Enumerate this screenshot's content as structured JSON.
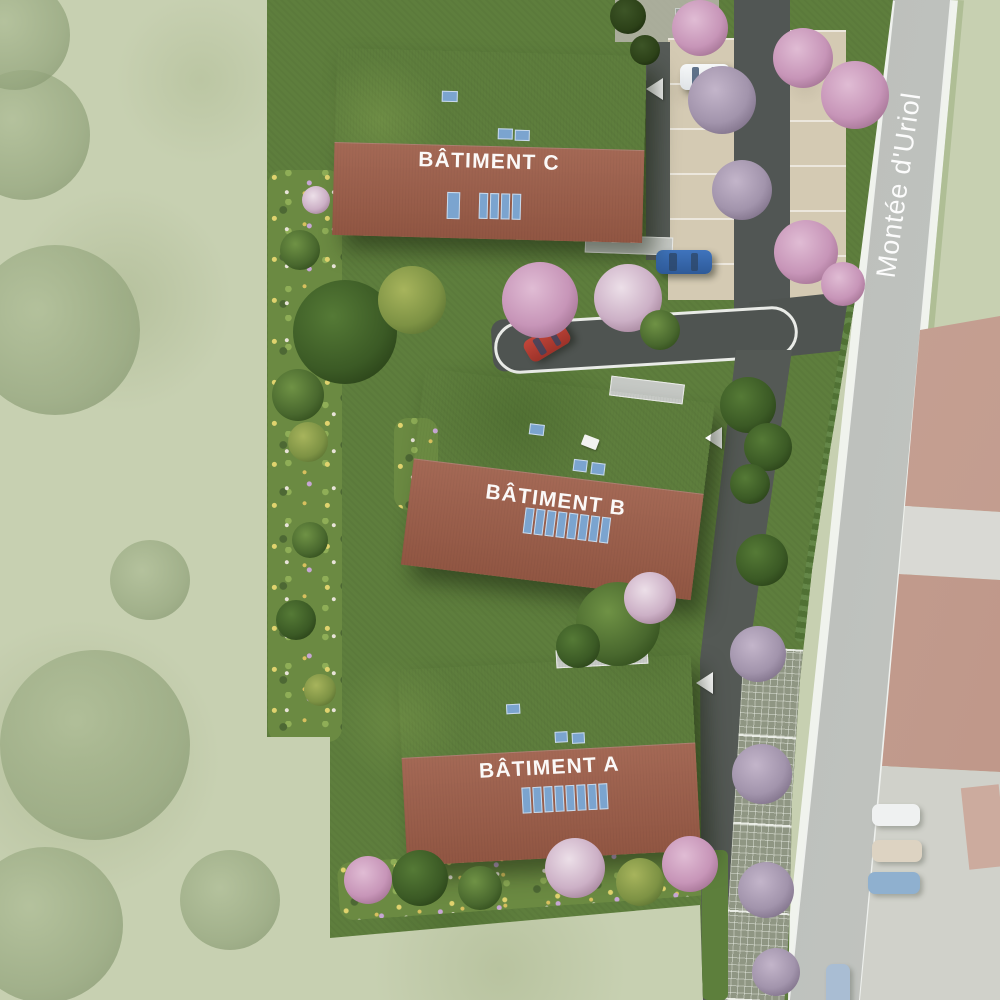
{
  "plan": {
    "street_name": "Montée d'Uriol",
    "buildings": [
      {
        "id": "C",
        "label": "BÂTIMENT C",
        "skylights": 3,
        "solar_panels": 5
      },
      {
        "id": "B",
        "label": "BÂTIMENT B",
        "skylights": 3,
        "solar_panels": 8
      },
      {
        "id": "A",
        "label": "BÂTIMENT A",
        "skylights": 3,
        "solar_panels": 8
      }
    ],
    "colors": {
      "roof_upper": "#b5816b",
      "roof_lower": "#9d5d48",
      "grass": "#5e7e3d",
      "faded_grass": "#c7d0b1",
      "road": "#c2c5c1",
      "driveway": "#4f5451",
      "parking": "#d4cab3",
      "solar_panel": "#7ba4cf",
      "blossom": "#cf9fc0",
      "arrow": "#ffffff"
    },
    "markers": {
      "direction_arrow_count": 5
    },
    "vehicles": {
      "red": 1,
      "blue": 3,
      "white": 2,
      "beige": 1,
      "dark": 1
    }
  }
}
